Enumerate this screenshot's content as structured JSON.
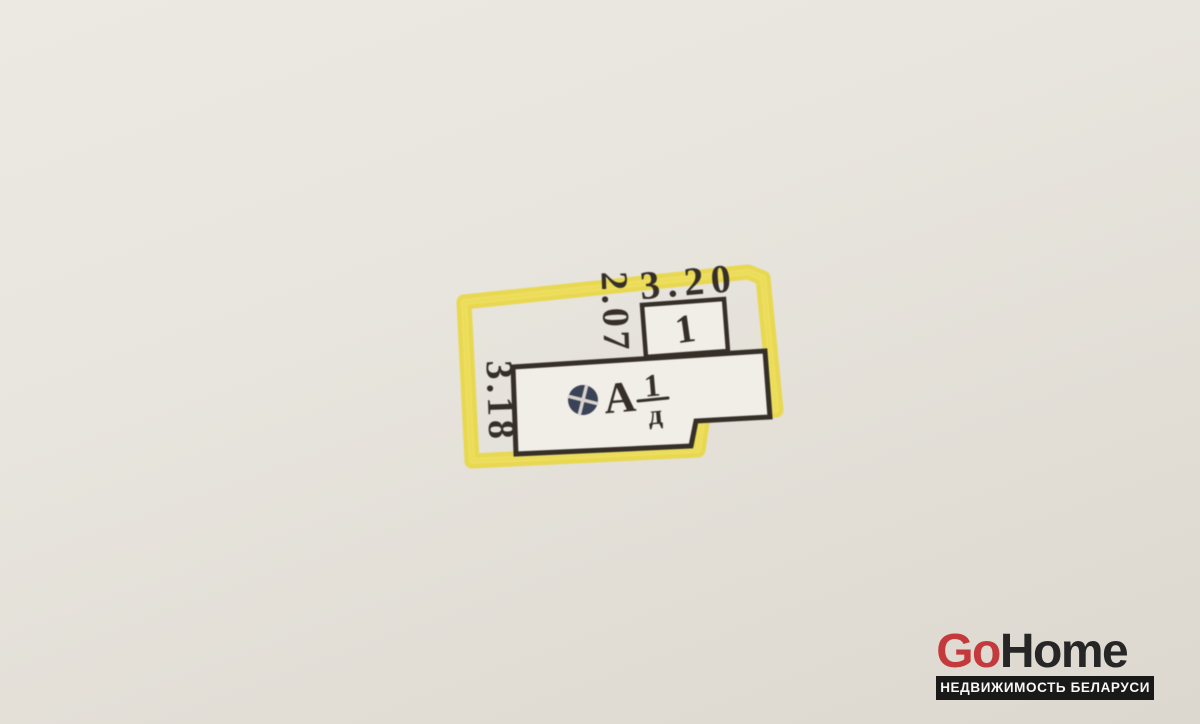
{
  "scene": {
    "description": "Photograph of a hand-drawn cadastral floor plan with a yellow highlighted parcel boundary"
  },
  "colors": {
    "paper_light": "#ece9e2",
    "paper_dark": "#dcd7cf",
    "room_fill": "#f1eee7",
    "ink": "#352f28",
    "parcel_line": "#8a7a64",
    "highlight": "#e8d63d",
    "highlight_core": "#f2e56b",
    "stamp": "#3a4258",
    "stamp_cross": "#d8d4cc",
    "logo_red": "#c43a3c",
    "logo_dark": "#262626",
    "banner_bg": "#191919",
    "banner_text": "#f7f7f7"
  },
  "plan": {
    "dim_top": "3.20",
    "dim_inner_vertical": "2.07",
    "dim_left_vertical": "3.18",
    "room_number": "1",
    "building_letter": "А",
    "building_fraction_top": "1",
    "building_fraction_bottom": "д"
  },
  "watermark": {
    "brand_red": "Go",
    "brand_dark": "Home",
    "tagline": "НЕДВИЖИМОСТЬ БЕЛАРУСИ"
  }
}
